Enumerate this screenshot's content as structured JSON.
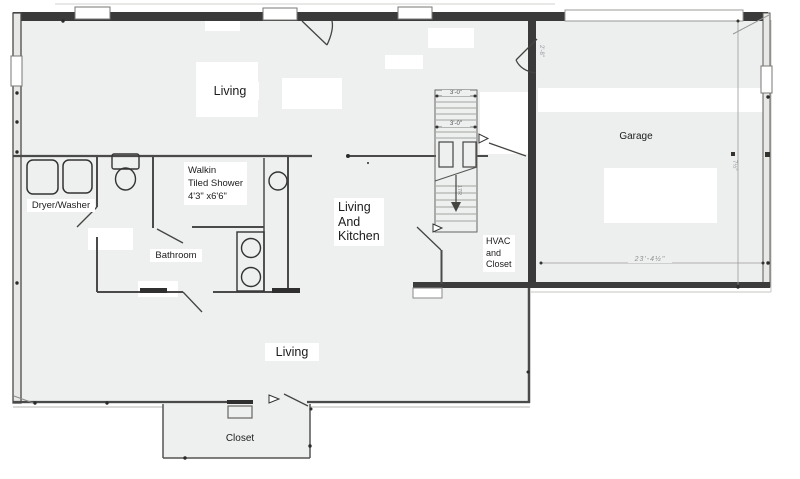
{
  "colors": {
    "paper": "#ffffff",
    "floor": "#eef0ef",
    "wall_dark": "#3a3a3a",
    "wall_medium": "#4a4a4a",
    "thin_line": "#9a9a9a",
    "label_text": "#1c1c1c",
    "faint_note": "#9a9aa2"
  },
  "rooms": {
    "living_top": {
      "label": "Living"
    },
    "dryer_washer": {
      "label": "Dryer/Washer"
    },
    "shower": {
      "lines": [
        "Walkin",
        "Tiled Shower",
        "4'3\" x6'6\""
      ]
    },
    "bathroom": {
      "label": "Bathroom"
    },
    "living_kitchen": {
      "lines": [
        "Living",
        "And",
        "Kitchen"
      ]
    },
    "hvac": {
      "lines": [
        "HVAC",
        "and",
        "Closet"
      ]
    },
    "garage": {
      "label": "Garage"
    },
    "living_bottom": {
      "label": "Living"
    },
    "closet": {
      "label": "Closet"
    }
  },
  "dimensions": {
    "stairs_width_top": "3'-0\"",
    "stairs_width_mid": "3'-0\"",
    "garage_width": "23'-4½\"",
    "garage_side_note": "7½\"",
    "door_note": "2'-8\"",
    "stairs_run_note": "17R"
  },
  "fixtures": [
    "washer",
    "dryer",
    "toilet",
    "sink",
    "double-vanity",
    "walk-in-shower",
    "stairs",
    "door-swings",
    "windows",
    "garage-door"
  ]
}
